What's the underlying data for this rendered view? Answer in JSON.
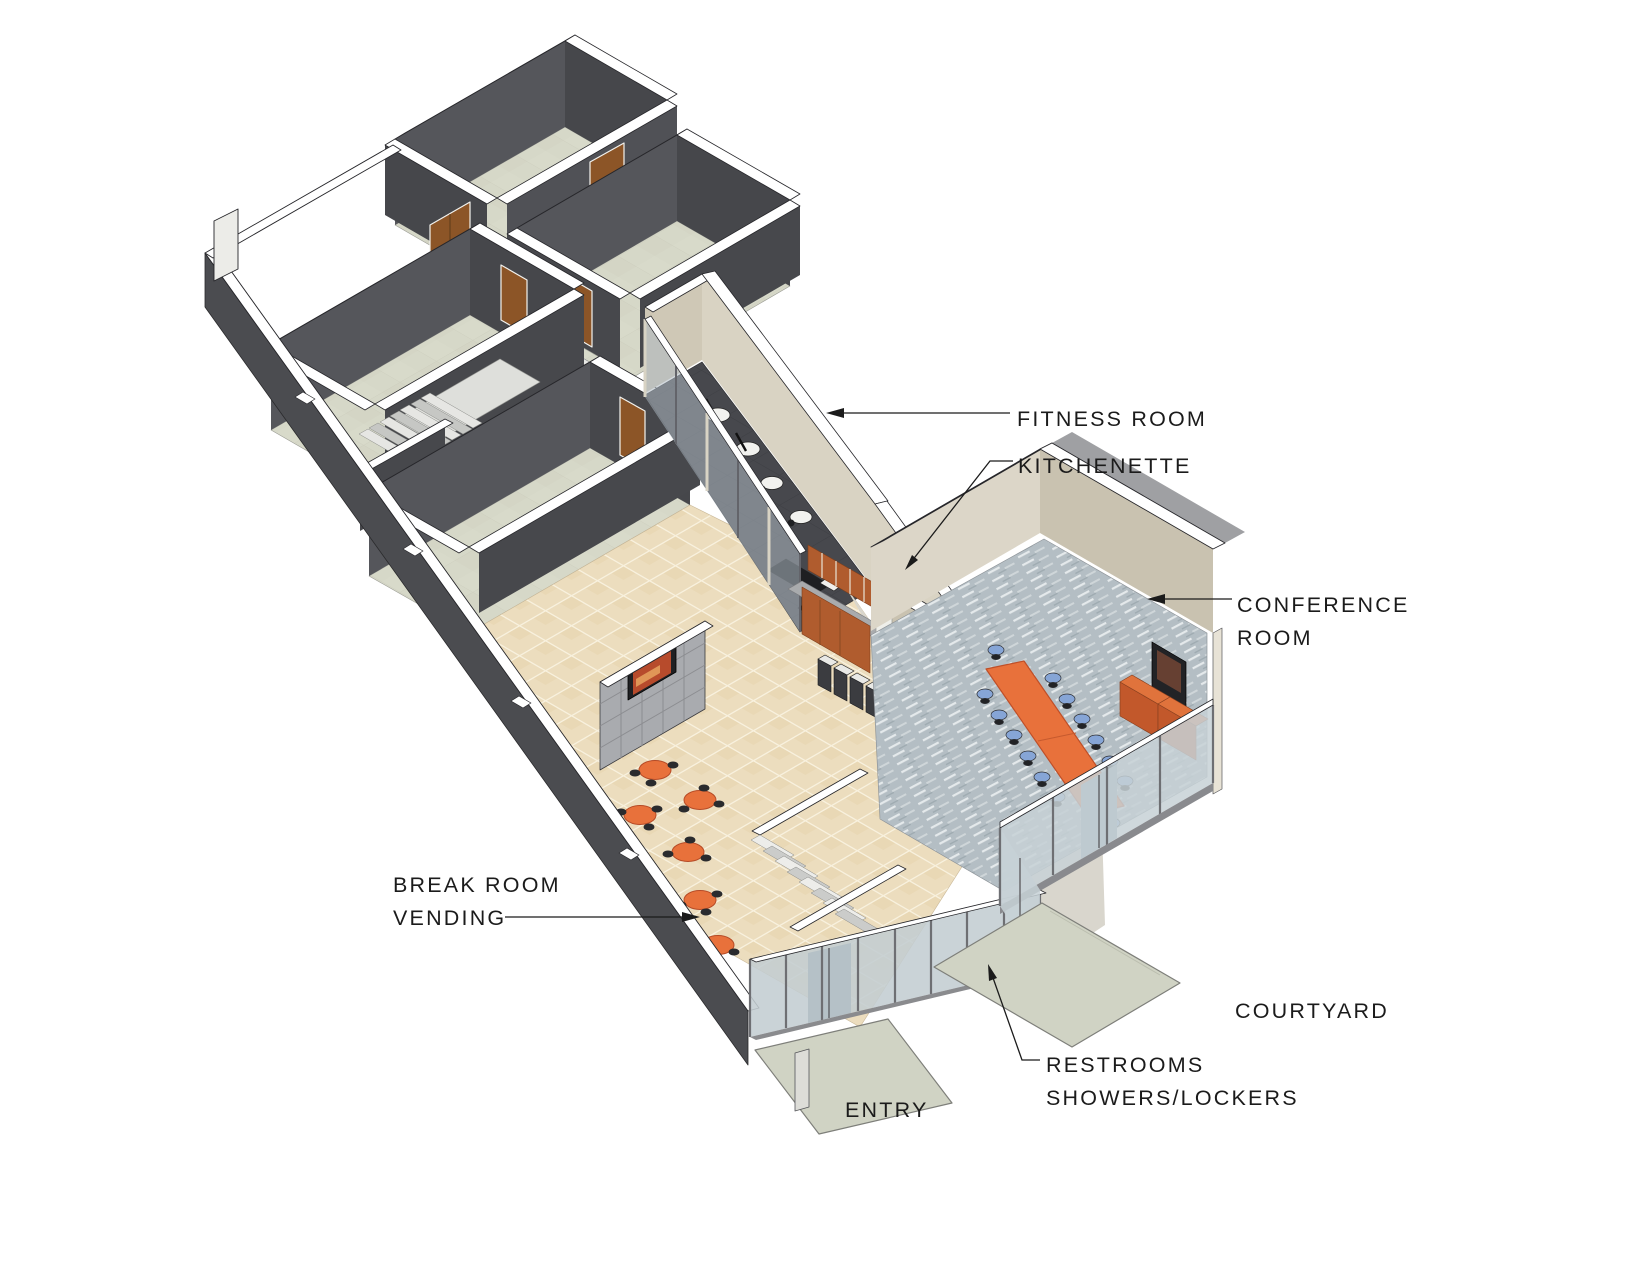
{
  "diagram": {
    "kind": "isometric-architectural-floor-plan",
    "annotations": {
      "fitness_room": "FITNESS ROOM",
      "kitchenette": "KITCHENETTE",
      "conference_room_line1": "CONFERENCE",
      "conference_room_line2": "ROOM",
      "break_room_line1": "BREAK ROOM",
      "break_room_line2": "VENDING",
      "restrooms_line1": "RESTROOMS",
      "restrooms_line2": "SHOWERS/LOCKERS",
      "courtyard": "COURTYARD",
      "entry": "ENTRY"
    },
    "colors": {
      "accent_orange": "#E8713B",
      "cabinet_orange": "#B05C2E",
      "wall_dark_se_face": "#55565B",
      "wall_dark_sw_face": "#46474B",
      "wall_beige_light": "#DCD6C8",
      "wall_beige_dark": "#C9C2B0",
      "exterior_wall": "#4B4C50",
      "carpet_green": "#D6D8C8",
      "tile_tan": "#ECDDBE",
      "fitness_floor": "#47484D",
      "conference_carpet": "#B4BEC4",
      "glass": "#C3CDD2",
      "chair_blue": "#86A5D6",
      "walkway_concrete": "#D0D3C4",
      "linework": "#1b1b1b"
    }
  }
}
